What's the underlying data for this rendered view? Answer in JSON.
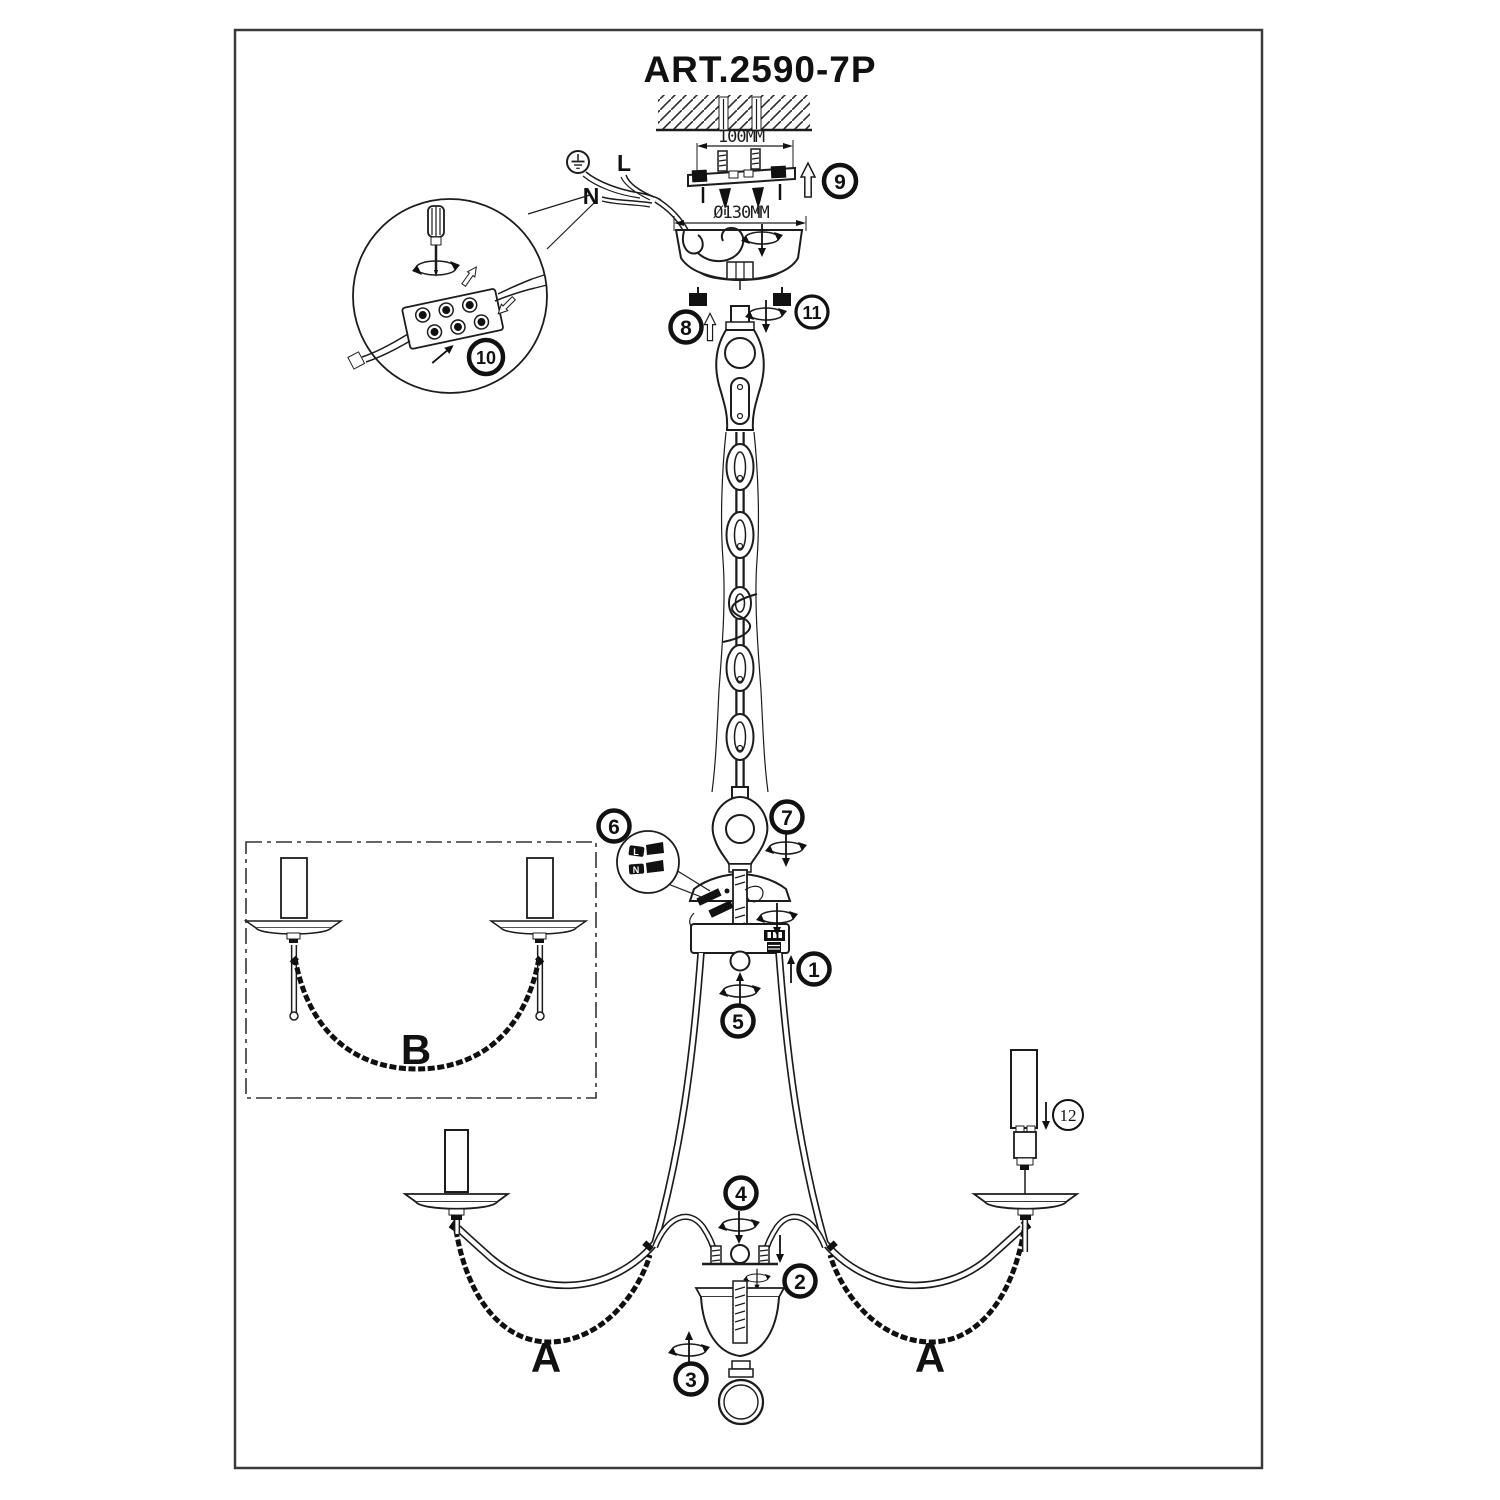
{
  "page": {
    "title": "ART.2590-7P"
  },
  "dimensions": {
    "mount_width": "100MM",
    "canopy_diameter": "Ø130MM"
  },
  "wiring": {
    "live": "L",
    "neutral": "N",
    "inset_live": "L",
    "inset_neutral": "N"
  },
  "part_labels": {
    "arm_left": "A",
    "arm_right": "A",
    "inset_arm": "B"
  },
  "callouts": [
    "1",
    "2",
    "3",
    "4",
    "5",
    "6",
    "7",
    "8",
    "9",
    "10",
    "11",
    "12"
  ],
  "icons": {
    "ground": "earth-ground-icon",
    "rotate": "rotate-arrow-icon",
    "arrow_up": "up-arrow-icon",
    "arrow_down": "down-arrow-icon",
    "screwdriver": "screwdriver-icon"
  },
  "colors": {
    "line": "#1c1c1c",
    "background": "#ffffff",
    "border": "#3a3a3a"
  }
}
